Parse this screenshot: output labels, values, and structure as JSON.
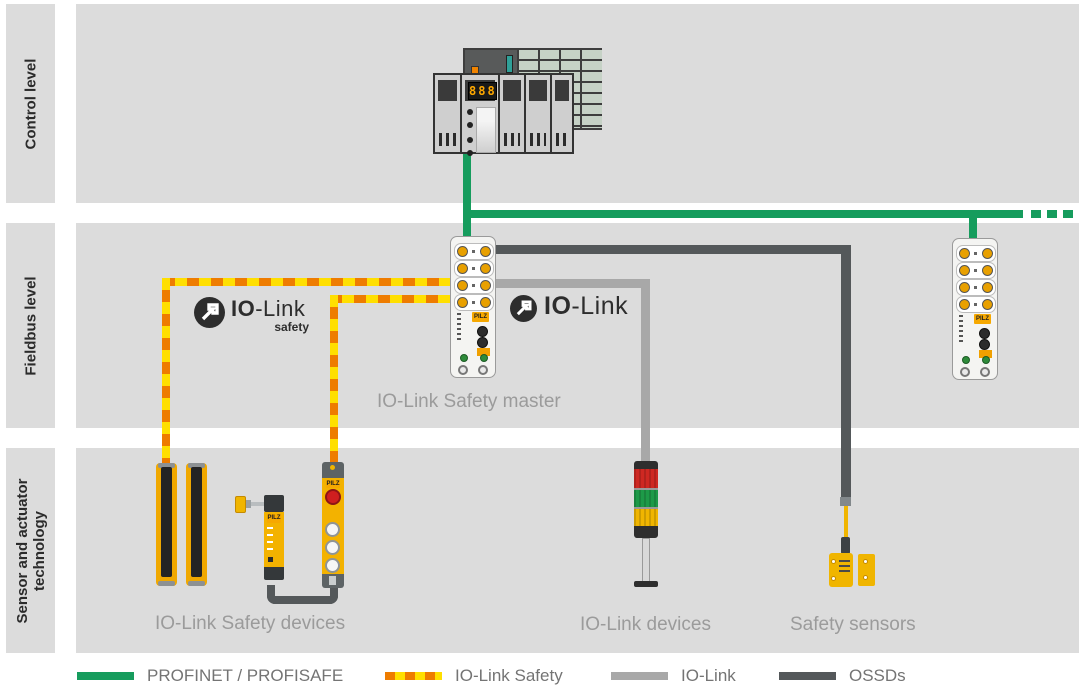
{
  "sidebar": {
    "levels": [
      {
        "label": "Control level"
      },
      {
        "label": "Fieldbus level"
      },
      {
        "label": "Sensor and actuator technology"
      }
    ]
  },
  "logos": {
    "io_link_safety": {
      "bold": "IO",
      "rest": "-Link",
      "sub": "safety"
    },
    "io_link": {
      "bold": "IO",
      "rest": "-Link"
    }
  },
  "devices": {
    "brand": "PILZ",
    "plc_display": "888"
  },
  "labels": {
    "safety_master": "IO-Link Safety master",
    "safety_devices": "IO-Link Safety devices",
    "io_devices": "IO-Link devices",
    "safety_sensors": "Safety sensors"
  },
  "legend": {
    "items": [
      {
        "label": "PROFINET / PROFISAFE",
        "style": "solid",
        "color": "#169c5d"
      },
      {
        "label": "IO-Link Safety",
        "style": "dashed",
        "colors": [
          "#ee7c00",
          "#ffdf00"
        ]
      },
      {
        "label": "IO-Link",
        "style": "solid",
        "color": "#a8a8a8"
      },
      {
        "label": "OSSDs",
        "style": "solid",
        "color": "#54585a"
      }
    ]
  },
  "colors": {
    "band_gray": "#dcdcdc",
    "profinet_green": "#169c5d",
    "iolink_safety_orange": "#ee7c00",
    "iolink_safety_yellow": "#ffdf00",
    "iolink_gray": "#a8a8a8",
    "ossd_dark": "#54585a",
    "device_yellow": "#f0a800",
    "label_gray": "#9b9b9b"
  }
}
